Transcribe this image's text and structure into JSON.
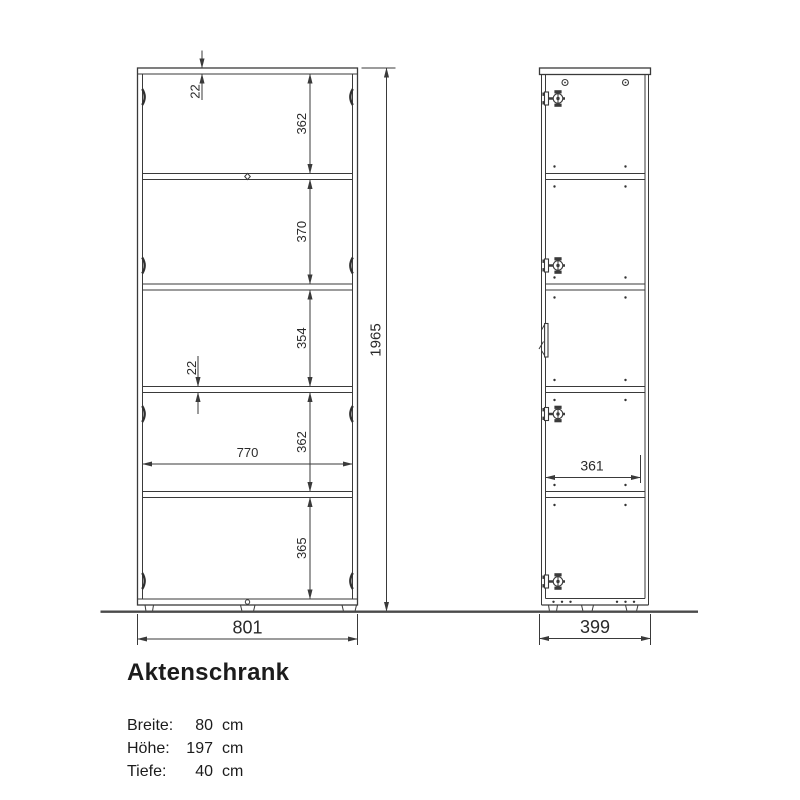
{
  "drawing": {
    "title": "Aktenschrank",
    "specs": [
      {
        "label": "Breite:",
        "value": "80",
        "unit": "cm"
      },
      {
        "label": "Höhe:",
        "value": "197",
        "unit": "cm"
      },
      {
        "label": "Tiefe:",
        "value": "40",
        "unit": "cm"
      }
    ],
    "dims": {
      "overall_height": "1965",
      "front_overall_width": "801",
      "front_inner_width": "770",
      "top_panel_thickness": "22",
      "shelf_thickness": "22",
      "front_chain": [
        "362",
        "370",
        "354",
        "362",
        "365"
      ],
      "side_overall_depth": "399",
      "side_inner_depth": "361"
    },
    "colors": {
      "line": "#3a3a3a",
      "text": "#1c1c1c",
      "background": "#ffffff"
    }
  }
}
